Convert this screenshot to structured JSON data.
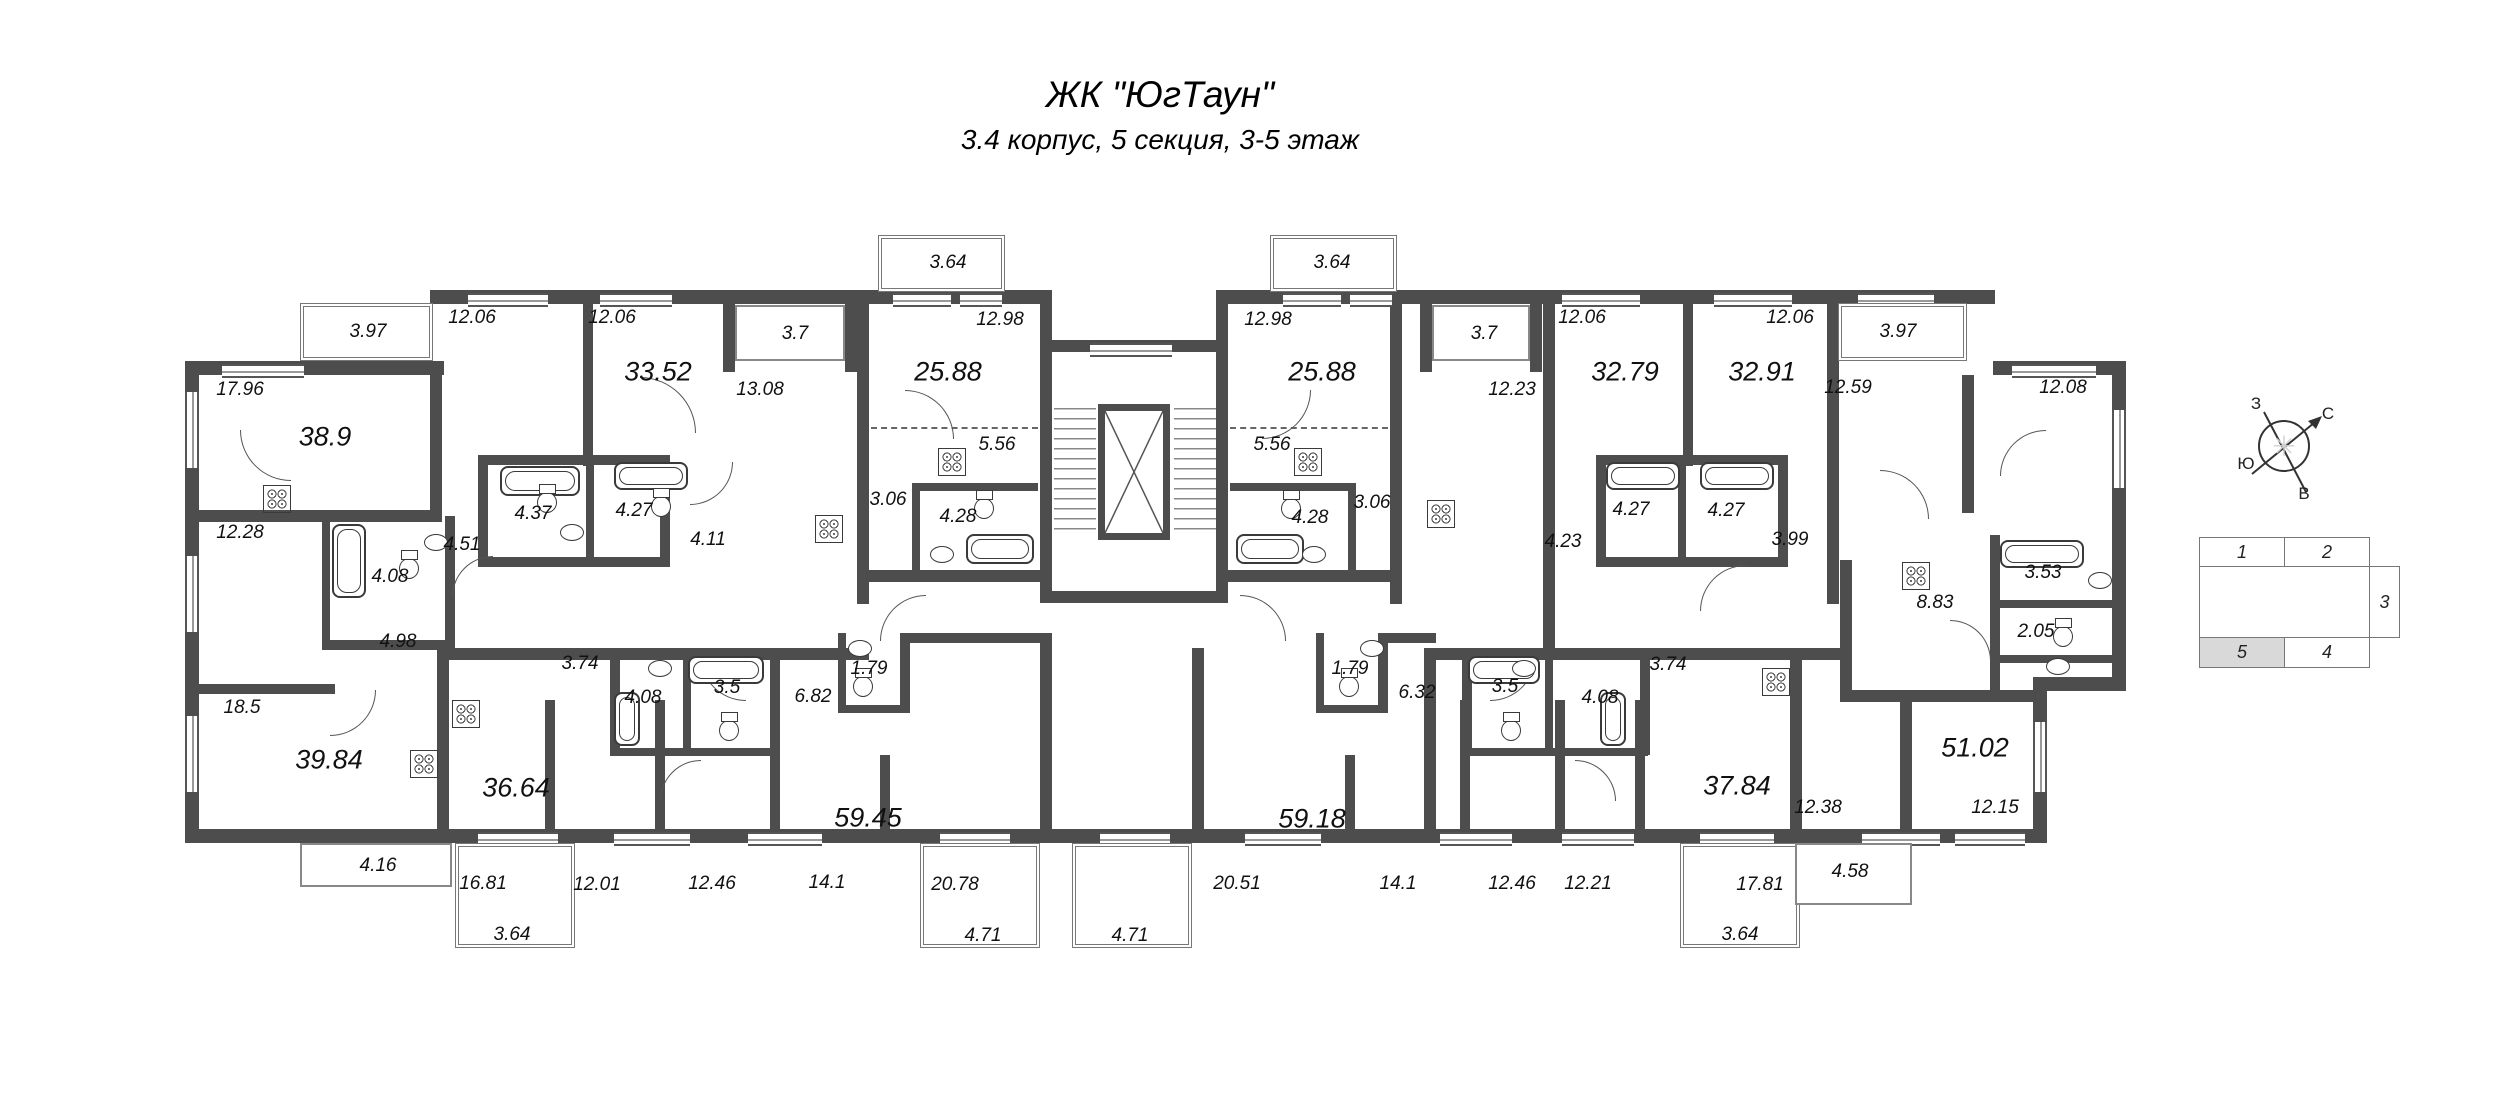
{
  "header": {
    "title": "ЖК \"ЮгТаун\"",
    "subtitle": "3.4 корпус, 5 секция, 3-5 этаж"
  },
  "plan": {
    "area_labels": [
      "3.97",
      "12.06",
      "12.06",
      "33.52",
      "3.7",
      "13.08",
      "3.64",
      "12.98",
      "25.88",
      "3.64",
      "12.98",
      "25.88",
      "3.7",
      "12.23",
      "12.06",
      "32.79",
      "12.06",
      "32.91",
      "3.97",
      "12.59",
      "12.08",
      "17.96",
      "38.9",
      "12.28",
      "4.08",
      "4.51",
      "4.37",
      "4.27",
      "4.11",
      "4.98",
      "18.5",
      "39.84",
      "4.16",
      "5.56",
      "3.06",
      "4.28",
      "5.56",
      "3.06",
      "4.28",
      "4.23",
      "4.27",
      "4.27",
      "3.99",
      "8.83",
      "3.53",
      "2.05",
      "3.74",
      "4.08",
      "3.5",
      "6.82",
      "1.79",
      "36.64",
      "59.45",
      "16.81",
      "12.01",
      "12.46",
      "14.1",
      "20.78",
      "3.64",
      "4.71",
      "4.71",
      "20.51",
      "59.18",
      "1.79",
      "6.32",
      "3.5",
      "4.08",
      "3.74",
      "14.1",
      "12.46",
      "12.21",
      "37.84",
      "17.81",
      "3.64",
      "4.58",
      "12.38",
      "51.02",
      "12.15"
    ]
  },
  "compass": {
    "north": "С",
    "south": "Ю",
    "west": "З",
    "east": "В"
  },
  "section_key": {
    "sections": [
      {
        "label": "1",
        "highlighted": false
      },
      {
        "label": "2",
        "highlighted": false
      },
      {
        "label": "3",
        "highlighted": false
      },
      {
        "label": "4",
        "highlighted": false
      },
      {
        "label": "5",
        "highlighted": true
      }
    ]
  },
  "colors": {
    "wall": "#4d4d4d",
    "section_highlight": "#d9d9d9"
  }
}
